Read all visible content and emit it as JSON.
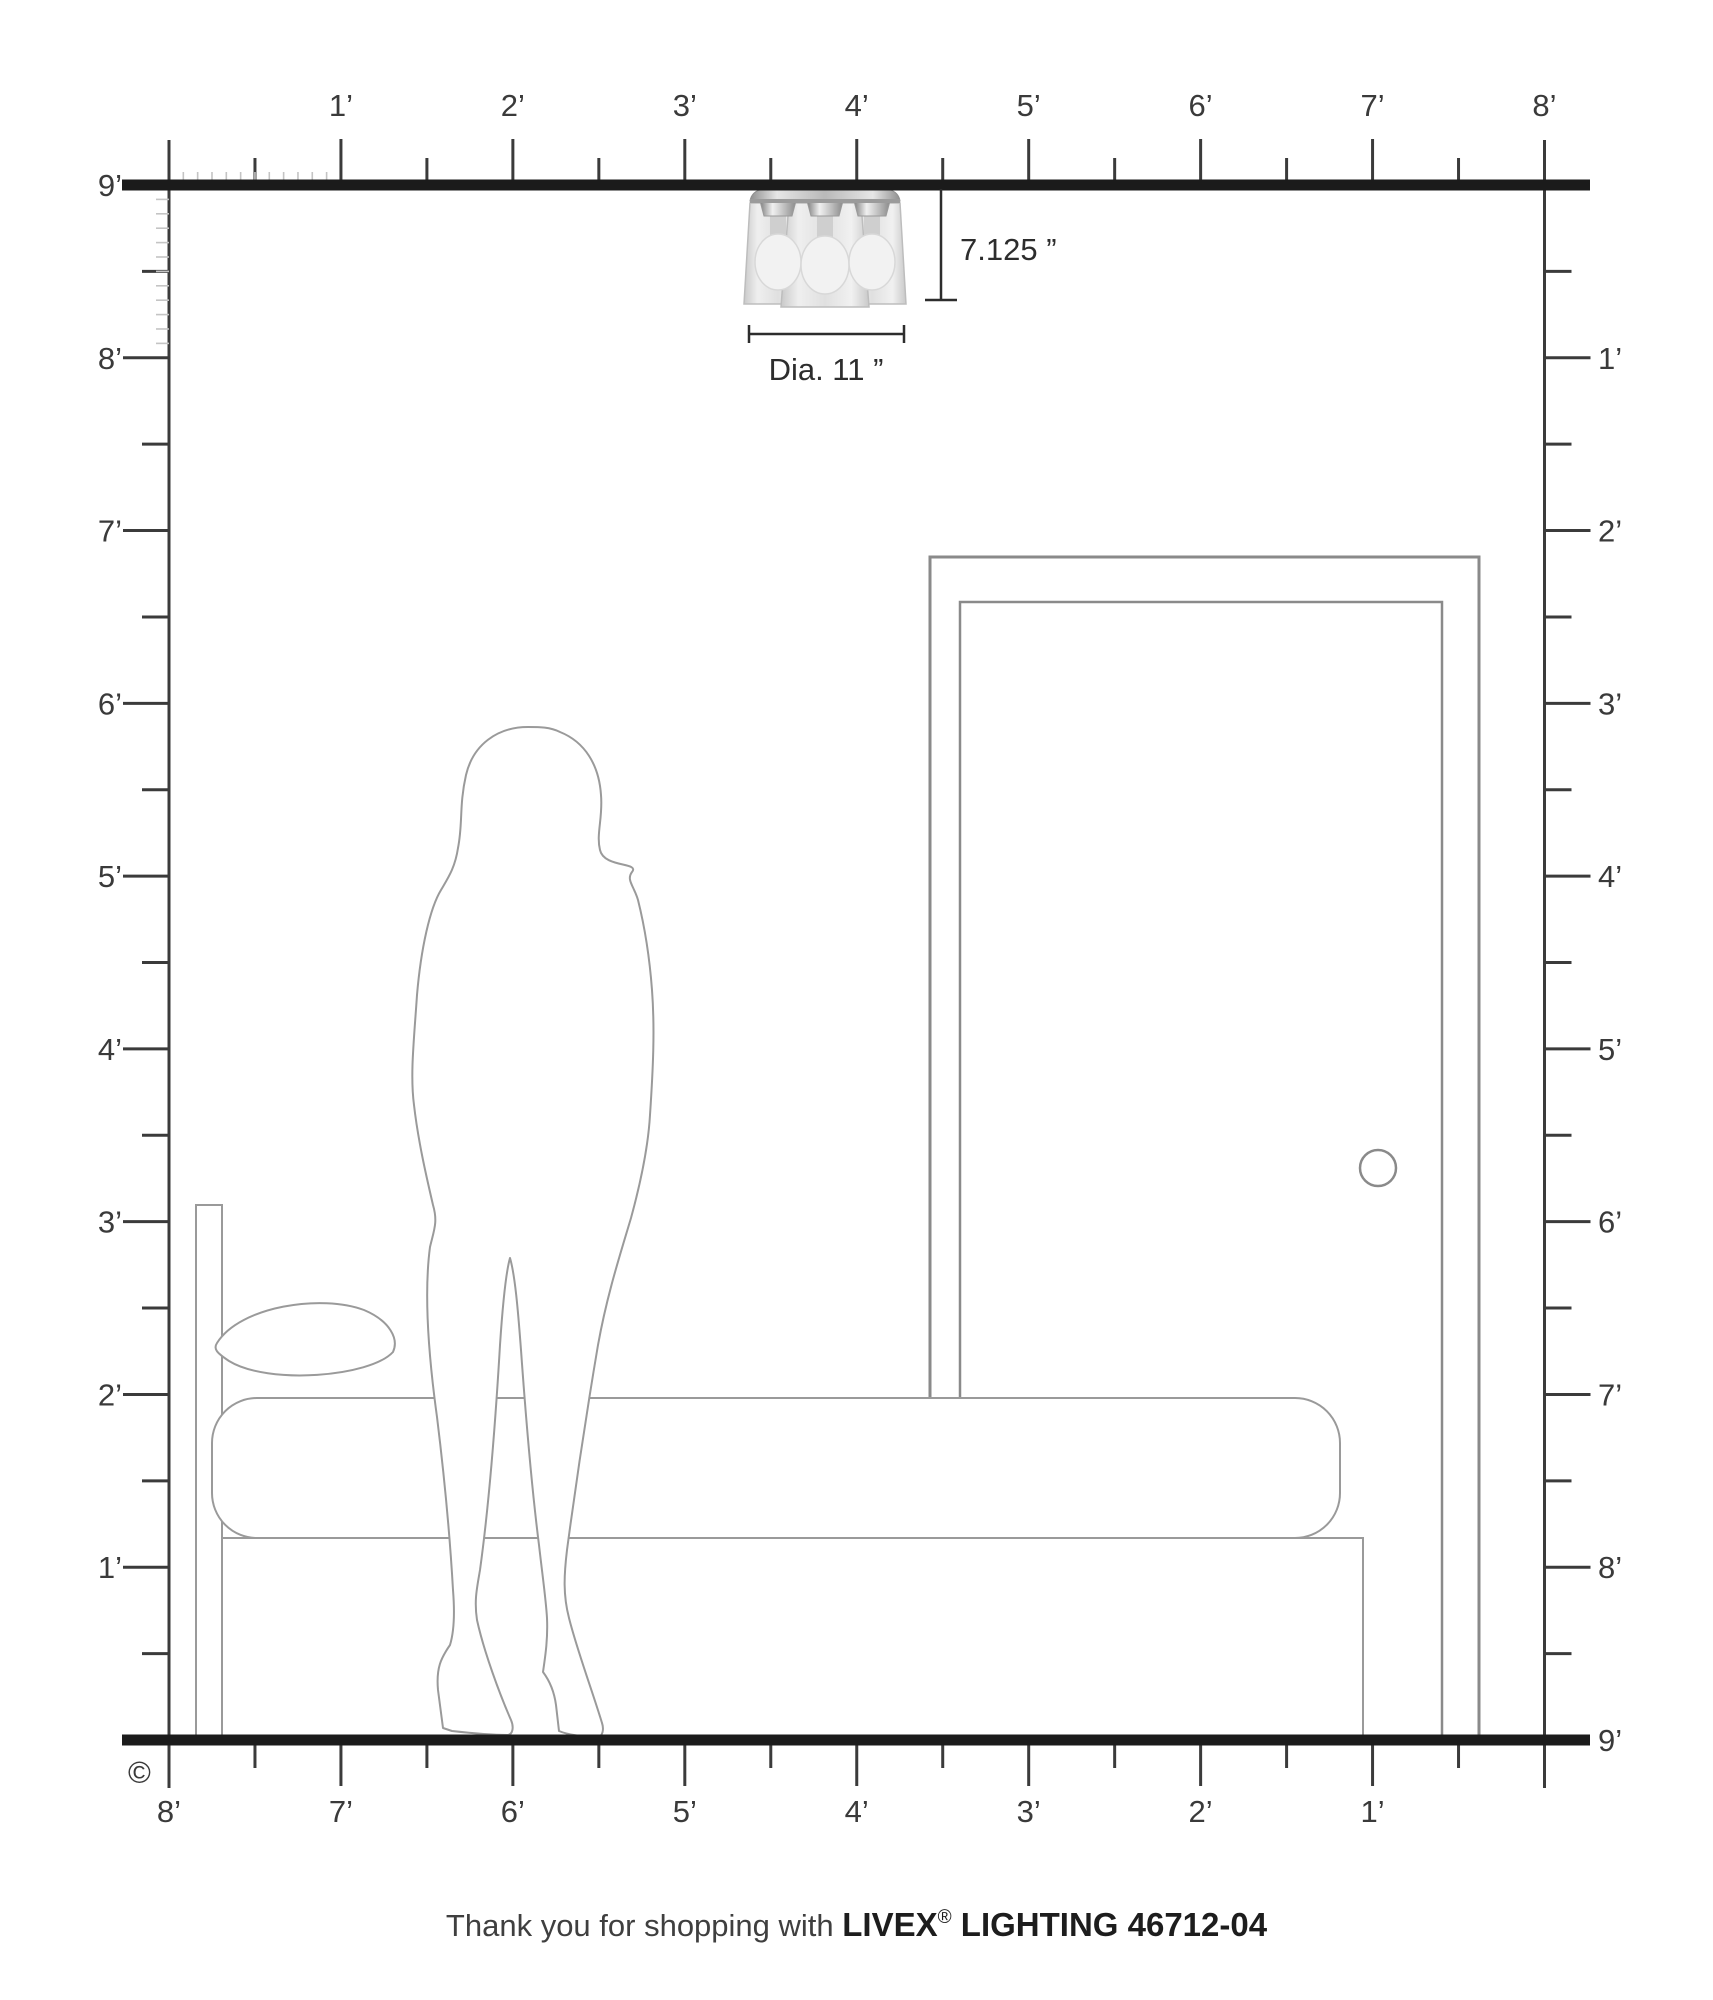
{
  "fixture": {
    "height_label": "7.125 ”",
    "diameter_label": "Dia. 11 ”"
  },
  "rulers": {
    "top": [
      "1’",
      "2’",
      "3’",
      "4’",
      "5’",
      "6’",
      "7’",
      "8’"
    ],
    "bottom": [
      "8’",
      "7’",
      "6’",
      "5’",
      "4’",
      "3’",
      "2’",
      "1’"
    ],
    "left": [
      "9’",
      "8’",
      "7’",
      "6’",
      "5’",
      "4’",
      "3’",
      "2’",
      "1’"
    ],
    "right": [
      "1’",
      "2’",
      "3’",
      "4’",
      "5’",
      "6’",
      "7’",
      "8’",
      "9’"
    ]
  },
  "footer": {
    "prefix": "Thank you for shopping with ",
    "brand": "LIVEX",
    "registered": "®",
    "product": " LIGHTING 46712-04"
  },
  "copyright": "©",
  "colors": {
    "line_dark": "#1b1b1b",
    "tick_dark": "#3b3b3b",
    "tick_light": "#c4c4c4",
    "furniture_gray": "#9a9a9a",
    "door_gray": "#8a8a8a"
  }
}
